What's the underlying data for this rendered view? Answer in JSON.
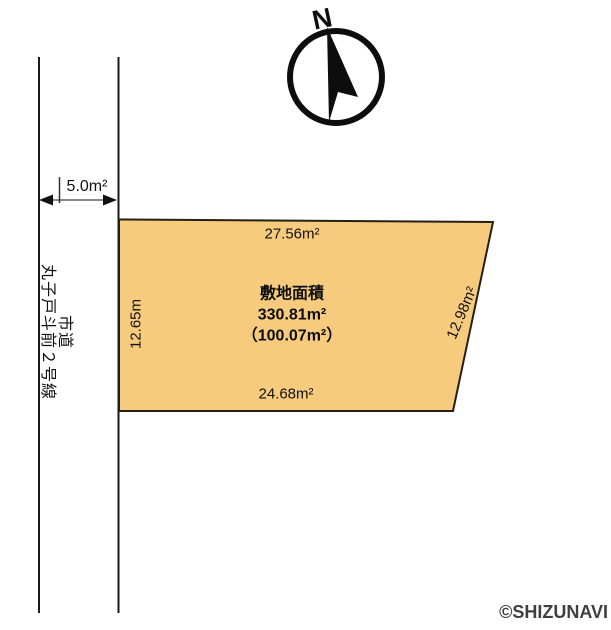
{
  "compass": {
    "north_label": "N"
  },
  "road": {
    "width_label": "5.0m²",
    "name_line1": "市道",
    "name_line2": "丸子戸斗前２号線"
  },
  "parcel": {
    "fill_color": "#F6CB7D",
    "area_title": "敷地面積",
    "area_value": "330.81m²",
    "area_sub": "（100.07m²）",
    "edge_top": "27.56m²",
    "edge_left": "12.65m",
    "edge_right": "12.98m²",
    "edge_bottom": "24.68m²"
  },
  "footer": {
    "copyright": "©SHIZUNAVI"
  }
}
